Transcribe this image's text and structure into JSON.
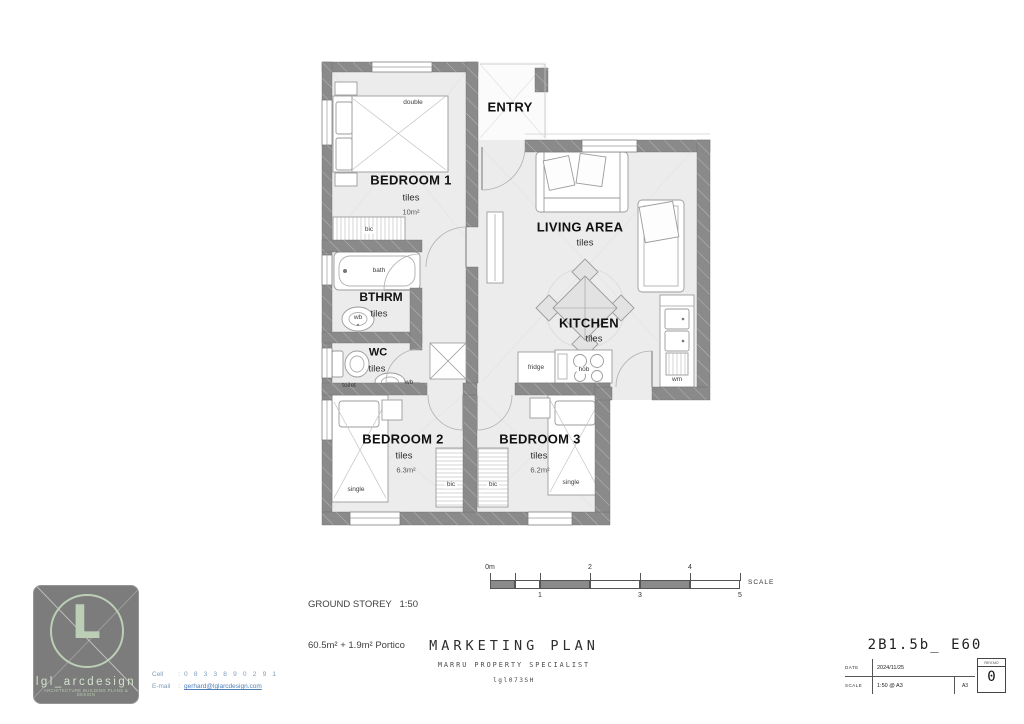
{
  "plan": {
    "entry": {
      "name": "ENTRY"
    },
    "bedroom1": {
      "name": "BEDROOM 1",
      "floor": "tiles",
      "area": "10m²",
      "bed": "double",
      "closet": "bic"
    },
    "living": {
      "name": "LIVING AREA",
      "floor": "tiles"
    },
    "kitchen": {
      "name": "KITCHEN",
      "floor": "tiles",
      "fridge": "fridge",
      "hob": "hob",
      "washing_machine": "wm"
    },
    "bathroom": {
      "name": "BTHRM",
      "floor": "tiles",
      "bath": "bath",
      "basin": "wb"
    },
    "wc": {
      "name": "WC",
      "floor": "tiles",
      "toilet": "toilet",
      "basin": "wb"
    },
    "bedroom2": {
      "name": "BEDROOM 2",
      "floor": "tiles",
      "area": "6.3m²",
      "bed": "single",
      "closet": "bic"
    },
    "bedroom3": {
      "name": "BEDROOM 3",
      "floor": "tiles",
      "area": "6.2m²",
      "bed": "single",
      "closet": "bic"
    }
  },
  "footer": {
    "storey_line1": "GROUND STOREY   1:50",
    "storey_line2": "60.5m² + 1.9m² Portico",
    "scale_bar": {
      "ticks_top": [
        "0m",
        "2",
        "4"
      ],
      "ticks_bottom": [
        "1",
        "3",
        "5"
      ],
      "caption": "SCALE"
    },
    "logo": {
      "monogram": "L",
      "name": "lgl_arcdesign",
      "tagline": "ARCHITECTURE BUILDING PLANS & DESIGN"
    },
    "contact": {
      "cell_label": "Cell",
      "cell_sep": ":",
      "cell": "0 8 3 3 8 9 0 2 9 1",
      "email_label": "E-mail",
      "email_sep": ":",
      "email": "gerhard@lglarcdesign.com"
    },
    "center": {
      "title": "MARKETING PLAN",
      "subtitle": "MARRU PROPERTY SPECIALIST",
      "code": "lgl073SH"
    },
    "sheet": {
      "code": "2B1.5b_ E60",
      "date_label": "DATE",
      "date": "2024/11/25",
      "scale_label": "SCALE",
      "scale": "1:50 @ A3",
      "paper": "A3",
      "rev_label": "REV.NO",
      "rev": "0"
    }
  },
  "colors": {
    "wall": "#8a8a8a",
    "floor": "#ececec",
    "logo_green": "#bccfb6",
    "link_blue": "#4f7fb5"
  }
}
